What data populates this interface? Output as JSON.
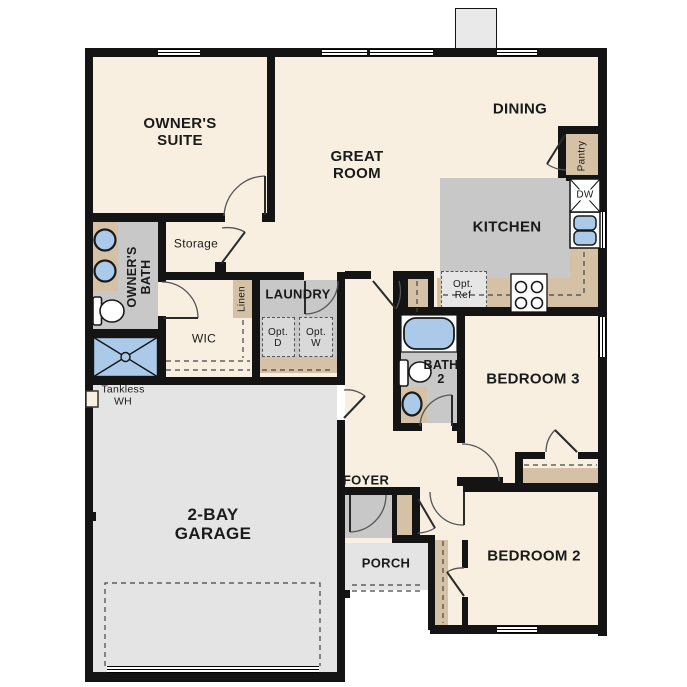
{
  "plan_title": "single-story floor plan",
  "palette": {
    "floor": "#f8efe1",
    "wall": "#141414",
    "gray": "#c8c8c8",
    "lgray": "#e4e4e4",
    "tan": "#d5c2a6",
    "blue": "#abcae9",
    "white": "#ffffff"
  },
  "labels": {
    "owners_suite": {
      "line1": "OWNER'S",
      "line2": "SUITE"
    },
    "great_room": {
      "line1": "GREAT",
      "line2": "ROOM"
    },
    "dining": {
      "label": "DINING"
    },
    "kitchen": {
      "label": "KITCHEN"
    },
    "owners_bath": {
      "line1": "OWNER'S",
      "line2": "BATH"
    },
    "storage": {
      "label": "Storage"
    },
    "wic": {
      "label": "WIC"
    },
    "linen_hall": {
      "label": "Linen"
    },
    "linen_foyer": {
      "label": "Linen"
    },
    "laundry": {
      "label": "LAUNDRY"
    },
    "opt_dryer": {
      "line1": "Opt.",
      "line2": "D"
    },
    "opt_washer": {
      "line1": "Opt.",
      "line2": "W"
    },
    "opt_ref": {
      "line1": "Opt.",
      "line2": "Ref"
    },
    "pantry": {
      "label": "Pantry"
    },
    "dishwasher": {
      "label": "DW"
    },
    "bath2": {
      "line1": "BATH",
      "line2": "2"
    },
    "bedroom3": {
      "label": "BEDROOM 3"
    },
    "bedroom2": {
      "label": "BEDROOM 2"
    },
    "foyer": {
      "label": "FOYER"
    },
    "porch": {
      "label": "PORCH"
    },
    "garage": {
      "line1": "2-BAY",
      "line2": "GARAGE"
    },
    "tankless_wh": {
      "line1": "Tankless",
      "line2": "WH"
    }
  }
}
